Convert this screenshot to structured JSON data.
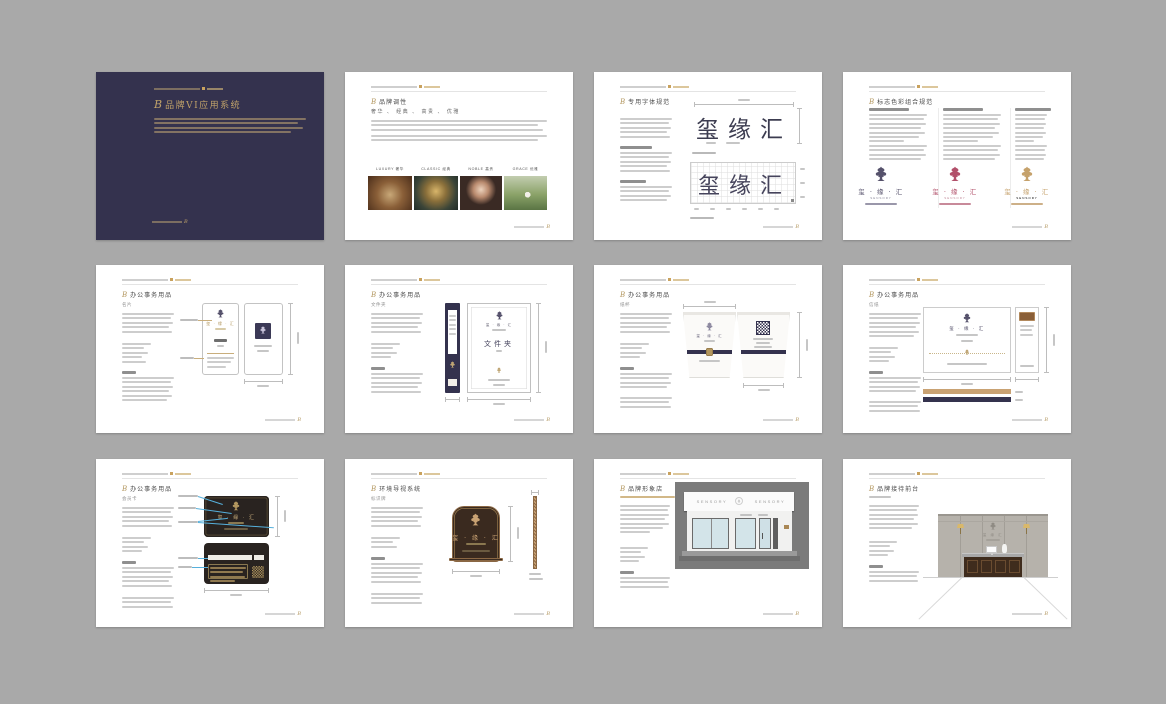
{
  "background": "#a9a9a9",
  "script_mark": "B",
  "brand": {
    "cn": "玺缘汇",
    "lockup": "玺 · 缘 · 汇",
    "en": "SENSORY"
  },
  "colors": {
    "navy": "#34324e",
    "gold": "#b3975f",
    "crimson": "#b2506a",
    "tan": "#c9a273",
    "annotation_blue": "#56b0dc",
    "card_dark": "#292320",
    "plaque_brown": "#3a2a1f",
    "bronze": "#8a6744"
  },
  "pages": {
    "cover": {
      "title": "品牌VI应用系统"
    },
    "tone": {
      "title": "品牌调性",
      "keywords": "奢华 、 经典 、 高贵 、 优雅",
      "captions": [
        "LUXURY 奢华",
        "CLASSIC 经典",
        "NOBLE 高贵",
        "GRACE 优雅"
      ]
    },
    "font": {
      "title": "专用字体规范",
      "specimen": "玺缘汇"
    },
    "logo": {
      "title": "标志色彩组合规范",
      "lockup": "玺 · 缘 · 汇",
      "en": "SENSORY"
    },
    "card": {
      "title": "办公事务用品",
      "item": "名片",
      "lockup": "玺 · 缘 · 汇"
    },
    "folder": {
      "title": "办公事务用品",
      "item": "文件夹",
      "cover_text": "文件夹",
      "lockup": "玺 · 缘 · 汇"
    },
    "cup": {
      "title": "办公事务用品",
      "item": "纸杯",
      "lockup": "玺 · 缘 · 汇"
    },
    "letter": {
      "title": "办公事务用品",
      "item": "信纸",
      "lockup": "玺 · 缘 · 汇"
    },
    "member": {
      "title": "办公事务用品",
      "item": "会员卡",
      "lockup": "玺 · 缘 · 汇"
    },
    "plaque": {
      "title": "环境导视系统",
      "item": "标识牌",
      "lockup": "玺 · 缘 · 汇"
    },
    "store": {
      "title": "品牌形象店",
      "sign": "SENSORY"
    },
    "reception": {
      "title": "品牌接待前台",
      "wall_text": "玺 缘 汇"
    }
  }
}
